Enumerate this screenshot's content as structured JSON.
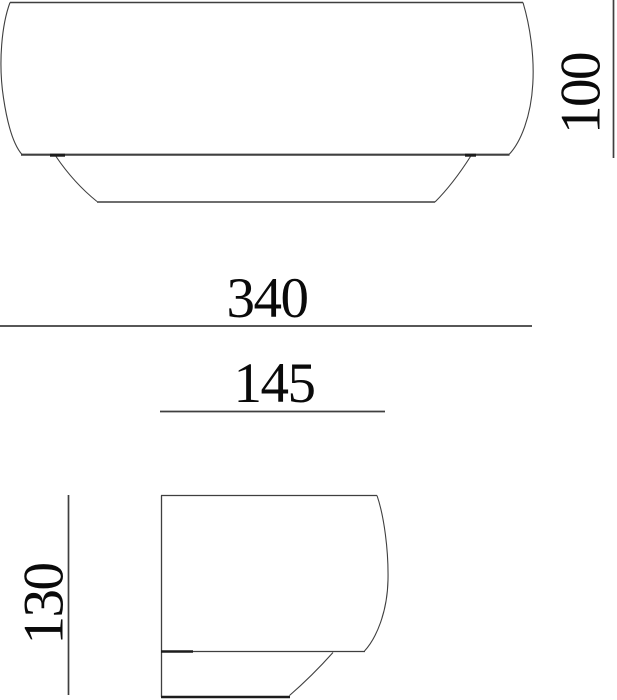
{
  "colors": {
    "background": "#ffffff",
    "outline": "#3f3f3f",
    "outline_light": "#5a5a5a",
    "outline_dark": "#1c1c1c",
    "text": "#0a0a0a"
  },
  "dimensions": {
    "front_width": "340",
    "front_height": "100",
    "side_depth": "145",
    "side_height": "130"
  }
}
